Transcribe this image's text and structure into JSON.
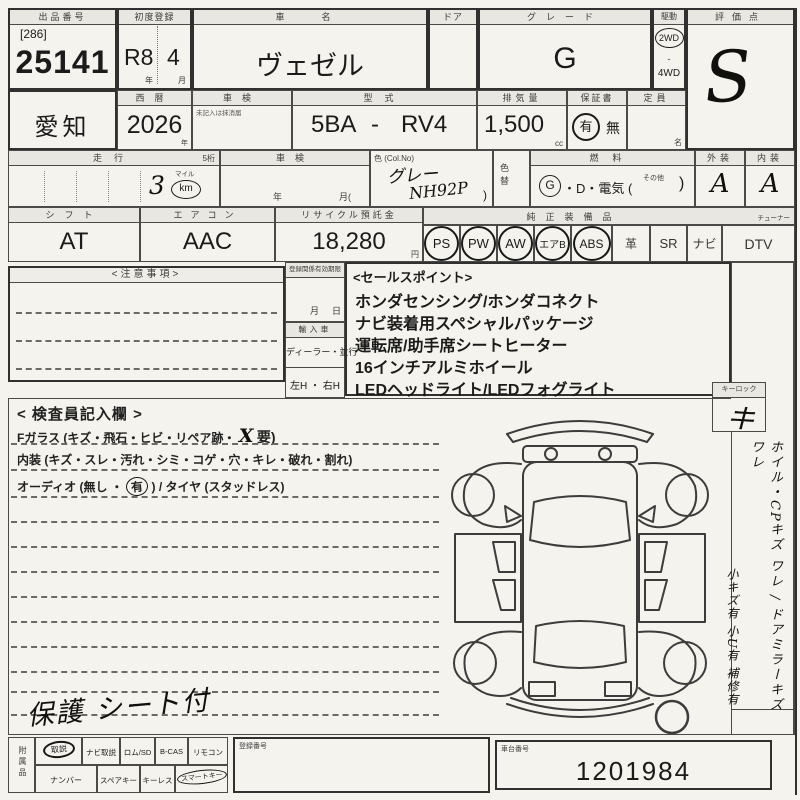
{
  "lot": {
    "label": "出品番号",
    "bracket": "[286]",
    "number": "25141"
  },
  "first_registration": {
    "label": "初度登録",
    "era_year": "R8",
    "month": "4",
    "year_suffix": "年",
    "month_suffix": "月"
  },
  "car_name": {
    "label": "車　名",
    "value": "ヴェゼル"
  },
  "door": {
    "label": "ドア"
  },
  "grade": {
    "label": "グレード",
    "value": "G"
  },
  "drive": {
    "label": "駆動",
    "opt1": "2WD",
    "opt2": "4WD",
    "selected": "2WD"
  },
  "score": {
    "label": "評価点",
    "value": "S"
  },
  "prefecture": {
    "value": "愛知"
  },
  "year_western": {
    "label": "西暦",
    "value": "2026",
    "suffix": "年"
  },
  "shaken_upper": {
    "label": "車検",
    "note": "未記入は抹消届",
    "value": ""
  },
  "model_code": {
    "label": "型式",
    "left": "5BA",
    "dash": "-",
    "right": "RV4"
  },
  "displacement": {
    "label": "排気量",
    "value": "1,500",
    "unit": "cc"
  },
  "warranty": {
    "label": "保証書",
    "opt_yes": "有",
    "opt_no": "無",
    "selected": "有"
  },
  "capacity": {
    "label": "定員",
    "unit": "名",
    "value": ""
  },
  "mileage": {
    "label": "走行",
    "digits_note": "5桁",
    "value": "3",
    "mile_label": "マイル",
    "km_label": "km",
    "unit_selected": "km"
  },
  "shaken_lower": {
    "label": "車検",
    "year_suffix": "年",
    "month_open": "月(",
    "value": ""
  },
  "color": {
    "label": "色 (Col.No)",
    "name": "グレー",
    "code": "NH92P",
    "paren": ")"
  },
  "color_change": {
    "label": "色替"
  },
  "fuel": {
    "label": "燃料",
    "g": "G",
    "rest": "・D・電気 (",
    "other": "その他",
    "close": ")",
    "selected": "G"
  },
  "exterior": {
    "label": "外装",
    "value": "A"
  },
  "interior": {
    "label": "内装",
    "value": "A"
  },
  "shift": {
    "label": "シフト",
    "value": "AT"
  },
  "aircon": {
    "label": "エアコン",
    "value": "AAC"
  },
  "recycle_deposit": {
    "label": "リサイクル預託金",
    "value": "18,280",
    "unit": "円"
  },
  "equipment": {
    "label": "純正装備品",
    "tuner_note": "チューナー",
    "items": [
      {
        "label": "PS",
        "circled": true
      },
      {
        "label": "PW",
        "circled": true
      },
      {
        "label": "AW",
        "circled": true
      },
      {
        "label": "エアB",
        "circled": true
      },
      {
        "label": "ABS",
        "circled": true
      },
      {
        "label": "革",
        "circled": false
      },
      {
        "label": "SR",
        "circled": false
      },
      {
        "label": "ナビ",
        "circled": false
      },
      {
        "label": "DTV",
        "circled": false
      }
    ]
  },
  "notes_box": {
    "title": "<注意事項>"
  },
  "registration_validity": {
    "label": "登録関係有効期限",
    "month_suffix": "月",
    "day_suffix": "日"
  },
  "import_car": {
    "label": "輸入車",
    "dealer_parallel": "ディーラー・並行",
    "handle": "左H ・ 右H"
  },
  "sales_points": {
    "title": "<セールスポイント>",
    "items": [
      "ホンダセンシング/ホンダコネクト",
      "ナビ装着用スペシャルパッケージ",
      "運転席/助手席シートヒーター",
      "16インチアルミホイール",
      "LEDヘッドライト/LEDフォグライト"
    ]
  },
  "inspector": {
    "title": "< 検査員記入欄 >",
    "front_glass_text": "Fガラス (キズ・飛石・ヒビ・リペア跡・",
    "front_glass_mark": "X",
    "front_glass_tail": "要)",
    "interior_text": "内装 (キズ・スレ・汚れ・シミ・コゲ・穴・キレ・破れ・割れ)",
    "audio_pre": "オーディオ (無し ・",
    "audio_circled": "有",
    "audio_post": " ) / タイヤ (スタッドレス)"
  },
  "key_lock": {
    "label": "キーロック",
    "mark": "キ"
  },
  "handwritten_notes": {
    "protect_note": "保護 シート付",
    "side_note_1": "ホイル・CPキズ ワレ / ドアミラーキズ ワレ",
    "side_note_2": "小キズ有  小U有  補修有"
  },
  "accessories": {
    "label": "附属品",
    "row1": [
      {
        "label": "取説",
        "circled": true
      },
      {
        "label": "ナビ取説",
        "circled": false
      },
      {
        "label": "ロム/SD",
        "circled": false
      },
      {
        "label": "B-CAS",
        "circled": false
      },
      {
        "label": "リモコン",
        "circled": false
      }
    ],
    "row2": [
      {
        "label": "ナンバー",
        "circled": false
      },
      {
        "label": "スペアキー",
        "circled": false
      },
      {
        "label": "キーレス",
        "circled": false
      },
      {
        "label": "スマートキー",
        "circled": true
      }
    ]
  },
  "registration_number": {
    "label": "登録番号",
    "value": ""
  },
  "chassis_number": {
    "label": "車台番号",
    "value": "1201984"
  }
}
